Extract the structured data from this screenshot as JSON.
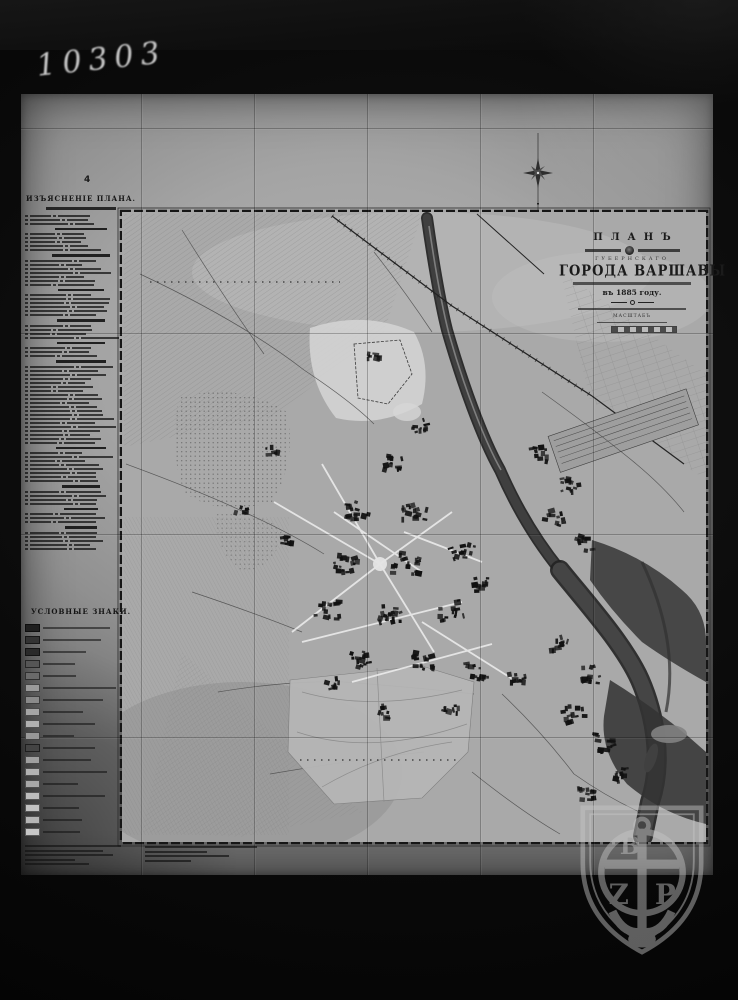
{
  "photo": {
    "archive_number": "10303"
  },
  "sheet": {
    "fold_marker": "4",
    "legend": {
      "title": "ИЗЪЯСНЕНІЕ ПЛАНА.",
      "signs_title": "УСЛОВНЫЕ ЗНАКИ."
    },
    "title_block": {
      "plan_word": "ПЛАНЪ",
      "gubernia_word": "ГУБЕРНСКАГО",
      "city_words": "ГОРОДА ВАРШАВЫ",
      "year_line": "въ 1885 году.",
      "scale_label": "МАСШТАБЪ"
    },
    "watermark": {
      "top_letter": "B",
      "left_letter": "Z",
      "right_letter": "P"
    }
  },
  "colors": {
    "background": "#050505",
    "paper": "#a6a6a6",
    "ink": "#1c1c1c",
    "river": "#383838",
    "watermark": "#c7c7c7"
  }
}
